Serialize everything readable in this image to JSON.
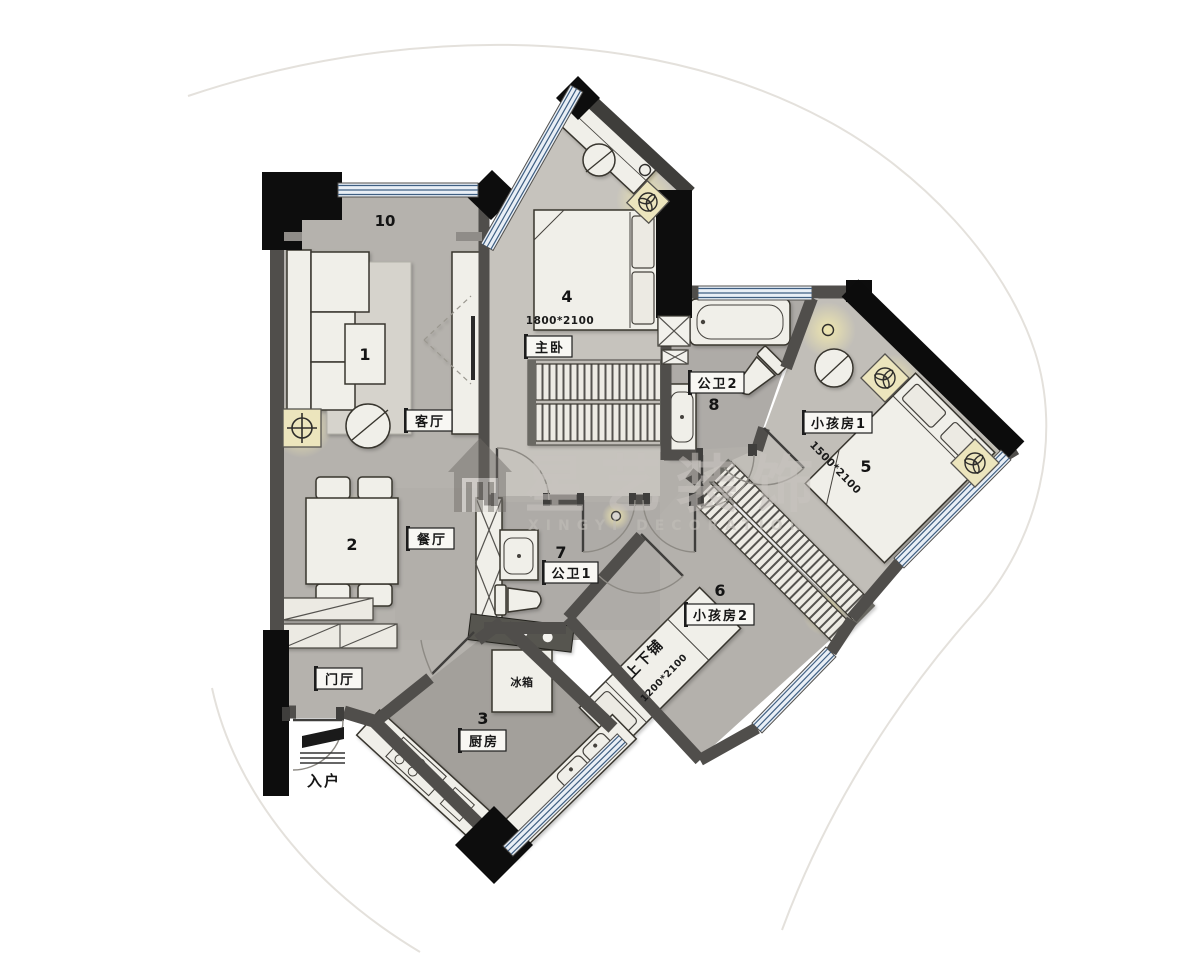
{
  "watermark": {
    "title": "星艺装饰",
    "subtitle": "XINGYI DECORATION",
    "logo": "house-icon"
  },
  "rooms": {
    "living": {
      "label": "客厅",
      "zone": "10",
      "table_no": "1"
    },
    "dining": {
      "label": "餐厅",
      "table_no": "2"
    },
    "hall": {
      "label": "门厅"
    },
    "entry": {
      "label": "入户"
    },
    "kitchen": {
      "label": "厨房",
      "no": "3",
      "fridge": "冰箱"
    },
    "master": {
      "label": "主卧",
      "no": "4",
      "bed_size": "1800*2100"
    },
    "bath1": {
      "label": "公卫1",
      "no": "7"
    },
    "bath2": {
      "label": "公卫2",
      "no": "8"
    },
    "kids1": {
      "label": "小孩房1",
      "no": "5",
      "bed_size": "1500*2100"
    },
    "kids2": {
      "label": "小孩房2",
      "no": "6",
      "bunk_label": "上下铺",
      "bunk_size": "1200*2100"
    }
  },
  "colors": {
    "wall": "#504e4b",
    "structure": "#0d0d0d",
    "floor": "#b5b2ad",
    "floor_light": "#c6c3bd",
    "floor_dark": "#a3a09b",
    "window_line": "#3f5f82",
    "furniture": "#f0efe9",
    "glow": "#f1e8ae",
    "watermark": "#c8c4bf"
  }
}
